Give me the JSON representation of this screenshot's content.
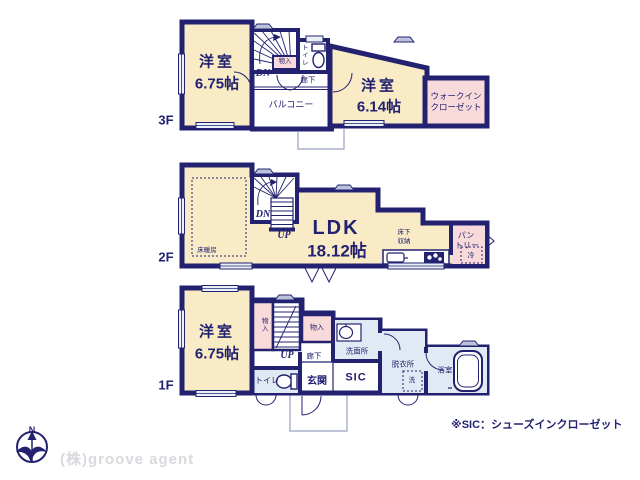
{
  "palette": {
    "wall_navy": "#232270",
    "room_cream": "#f8ebc5",
    "closet_pink": "#f9dada",
    "wet_blue": "#dfeaf4",
    "window_blue": "#e9f1f8",
    "outline_gray": "#9aa0c0",
    "watermark_gray": "#d9d9de"
  },
  "floor3": {
    "label": "3F",
    "bedroom_left": {
      "name": "洋室",
      "size": "6.75帖"
    },
    "stairs": {
      "dn": "DN"
    },
    "closet": {
      "label": "物入"
    },
    "toilet": {
      "label": "トイレ"
    },
    "hallway": {
      "label": "廊下"
    },
    "balcony": {
      "label": "バルコニー"
    },
    "bedroom_right": {
      "name": "洋室",
      "size": "6.14帖"
    },
    "walk_in_closet": {
      "line1": "ウォークイン",
      "line2": "クローゼット"
    }
  },
  "floor2": {
    "label": "2F",
    "floor_heating": {
      "label": "床暖房"
    },
    "stairs": {
      "dn": "DN",
      "up": "UP"
    },
    "ldk": {
      "name": "LDK",
      "size": "18.12帖"
    },
    "underfloor_storage": {
      "line1": "床下",
      "line2": "収納"
    },
    "pantry": {
      "line1": "パン",
      "line2": "トリー"
    },
    "fridge": {
      "label": "冷"
    }
  },
  "floor1": {
    "label": "1F",
    "bedroom": {
      "name": "洋室",
      "size": "6.75帖"
    },
    "closet_left": {
      "label": "物入"
    },
    "stairs": {
      "up": "UP"
    },
    "closet_hall": {
      "label": "物入"
    },
    "hallway": {
      "label": "廊下"
    },
    "washroom": {
      "label": "洗面所"
    },
    "toilet": {
      "label": "トイレ"
    },
    "entrance": {
      "label": "玄関"
    },
    "sic": {
      "label": "SIC"
    },
    "dressing_room": {
      "label": "脱衣所"
    },
    "washer": {
      "label": "洗"
    },
    "bathroom": {
      "label": "浴室"
    }
  },
  "footer": {
    "compass": {
      "label": "N"
    },
    "watermark": "(株)groove agent",
    "note": "※SIC：シューズインクローゼット"
  }
}
